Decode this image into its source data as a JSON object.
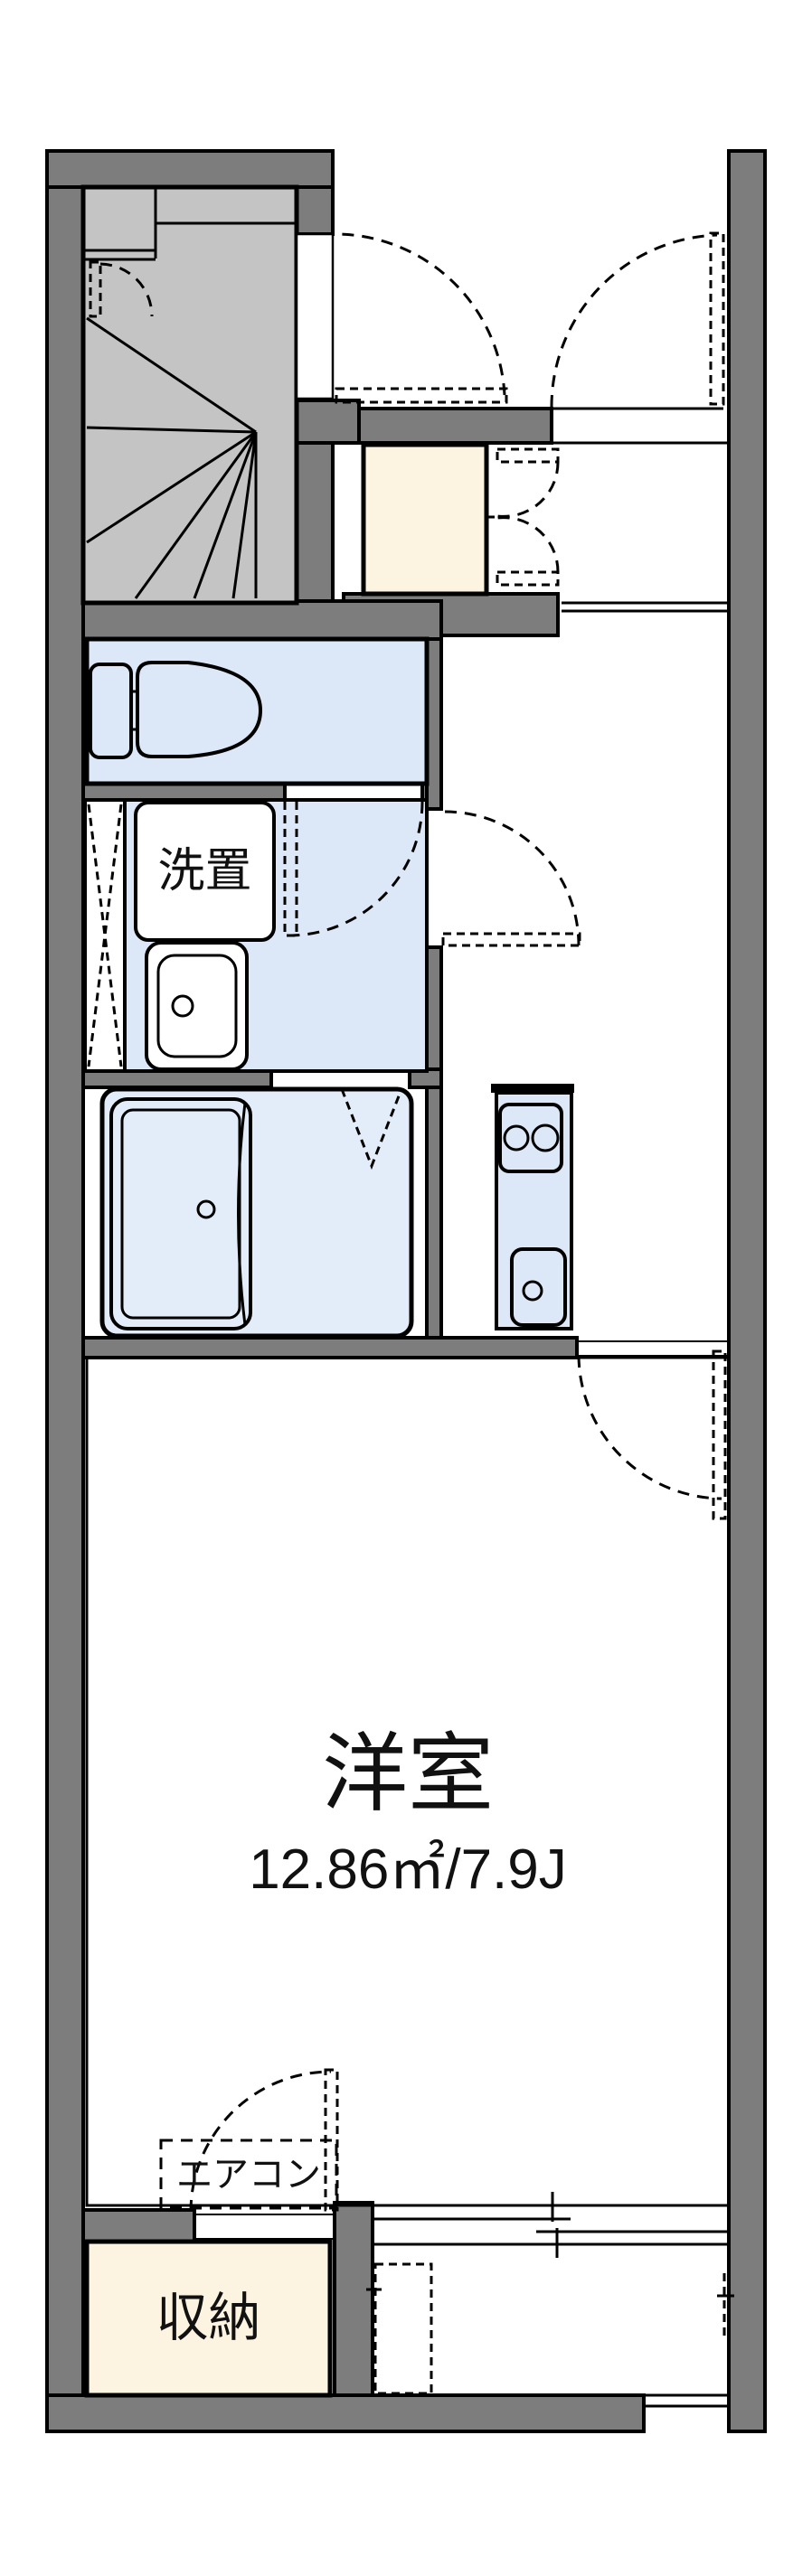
{
  "document": {
    "type": "apartment-floor-plan"
  },
  "labels": {
    "washer_space": "洗置",
    "main_room": "洋室",
    "main_room_area": "12.86㎡/7.9J",
    "aircon": "エアコン",
    "storage": "収納"
  },
  "colors": {
    "wall": "#7d7d7d",
    "stair_fill": "#c4c4c4",
    "water_fill": "#dce8f8",
    "bath_fill": "#e3edfa",
    "storage_fill": "#fdf3e1",
    "line": "#000000",
    "background": "#ffffff"
  }
}
